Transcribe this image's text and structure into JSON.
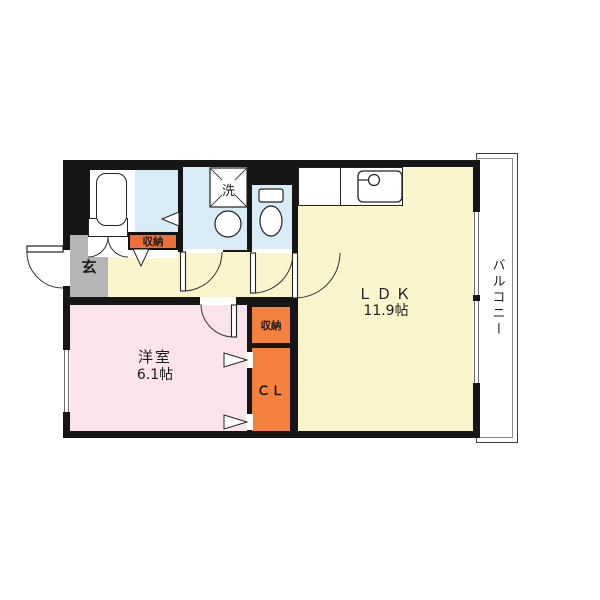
{
  "plan_title": "1LDK floor plan",
  "rooms": {
    "ldk": {
      "name": "ＬＤＫ",
      "size": "11.9帖"
    },
    "bedroom": {
      "name": "洋室",
      "size": "6.1帖"
    },
    "balcony": {
      "name": "バルコニー"
    },
    "entrance": {
      "name": "玄"
    },
    "laundry": {
      "name": "洗"
    },
    "hall_storage": {
      "name": "収納"
    },
    "mid_storage": {
      "name": "収納"
    },
    "closet": {
      "name": "ＣＬ"
    }
  },
  "colors": {
    "wall": "#161616",
    "ldk_floor": "#FAF5CD",
    "bedroom_floor": "#FAE3EA",
    "wet_area_floor": "#D8ECF8",
    "storage_orange": "#F5813E",
    "storage_label_orange": "#EF6F38",
    "entrance_gray": "#B5B5B5",
    "balcony_floor": "#FFFFFF"
  }
}
